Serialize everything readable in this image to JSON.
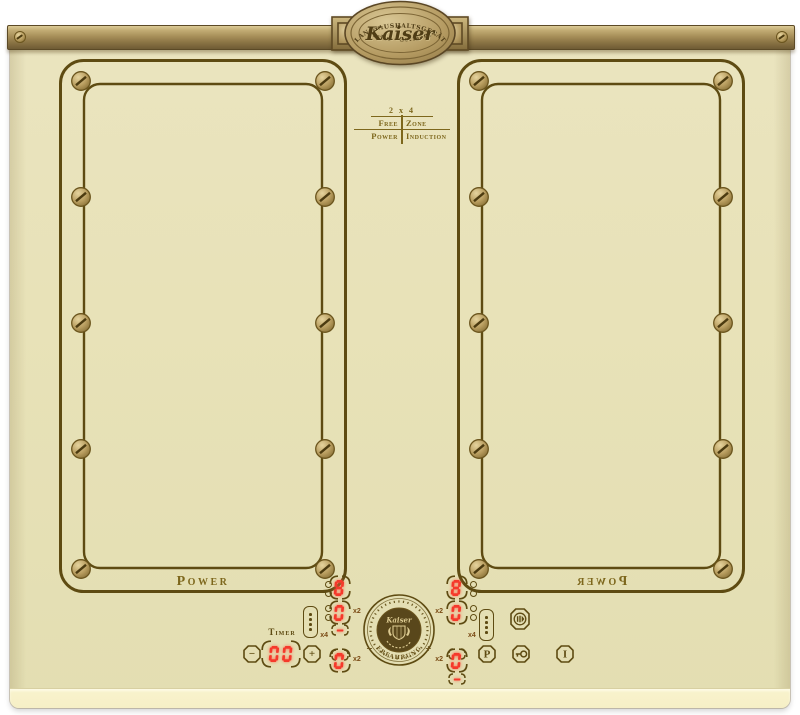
{
  "badge": {
    "top_arc": "OLAN-HAUSHALTSGERÄTE",
    "name": "Kaiser",
    "bottom_arc": "Berlin · Germany"
  },
  "free_zone_logo": {
    "line1": "2 x 4",
    "row1_left": "Free",
    "row1_right": "Zone",
    "row2_left": "Power",
    "row2_right": "Induction"
  },
  "zones": {
    "left_label": "Power",
    "right_label": "Power"
  },
  "emblem": {
    "name": "Kaiser",
    "arc_text": "Erfahrung",
    "minus_mark": "−",
    "plus_mark": "+"
  },
  "controls": {
    "timer": {
      "label": "Timer",
      "value": "00",
      "minus": "−",
      "plus": "+"
    },
    "left": {
      "aux_display": "8",
      "main_display": "0",
      "main_mult": "x2",
      "bridge_upper": "-",
      "bridge_lower": "-",
      "bridge_mult": "x4",
      "front_display": "0",
      "front_mult": "x2"
    },
    "right": {
      "aux_display": "8",
      "main_display": "0",
      "main_mult": "x2",
      "bridge_upper": "-",
      "bridge_lower": "-",
      "bridge_mult": "x4",
      "front_display": "0",
      "front_mult": "x2"
    },
    "buttons": {
      "boost": "P",
      "on_off": "I"
    }
  },
  "colors": {
    "surface": "#e8e2b8",
    "line": "#5e4b12",
    "gold": "#7d671c",
    "digit": "#f5392b",
    "brass": "#b49d6a"
  }
}
